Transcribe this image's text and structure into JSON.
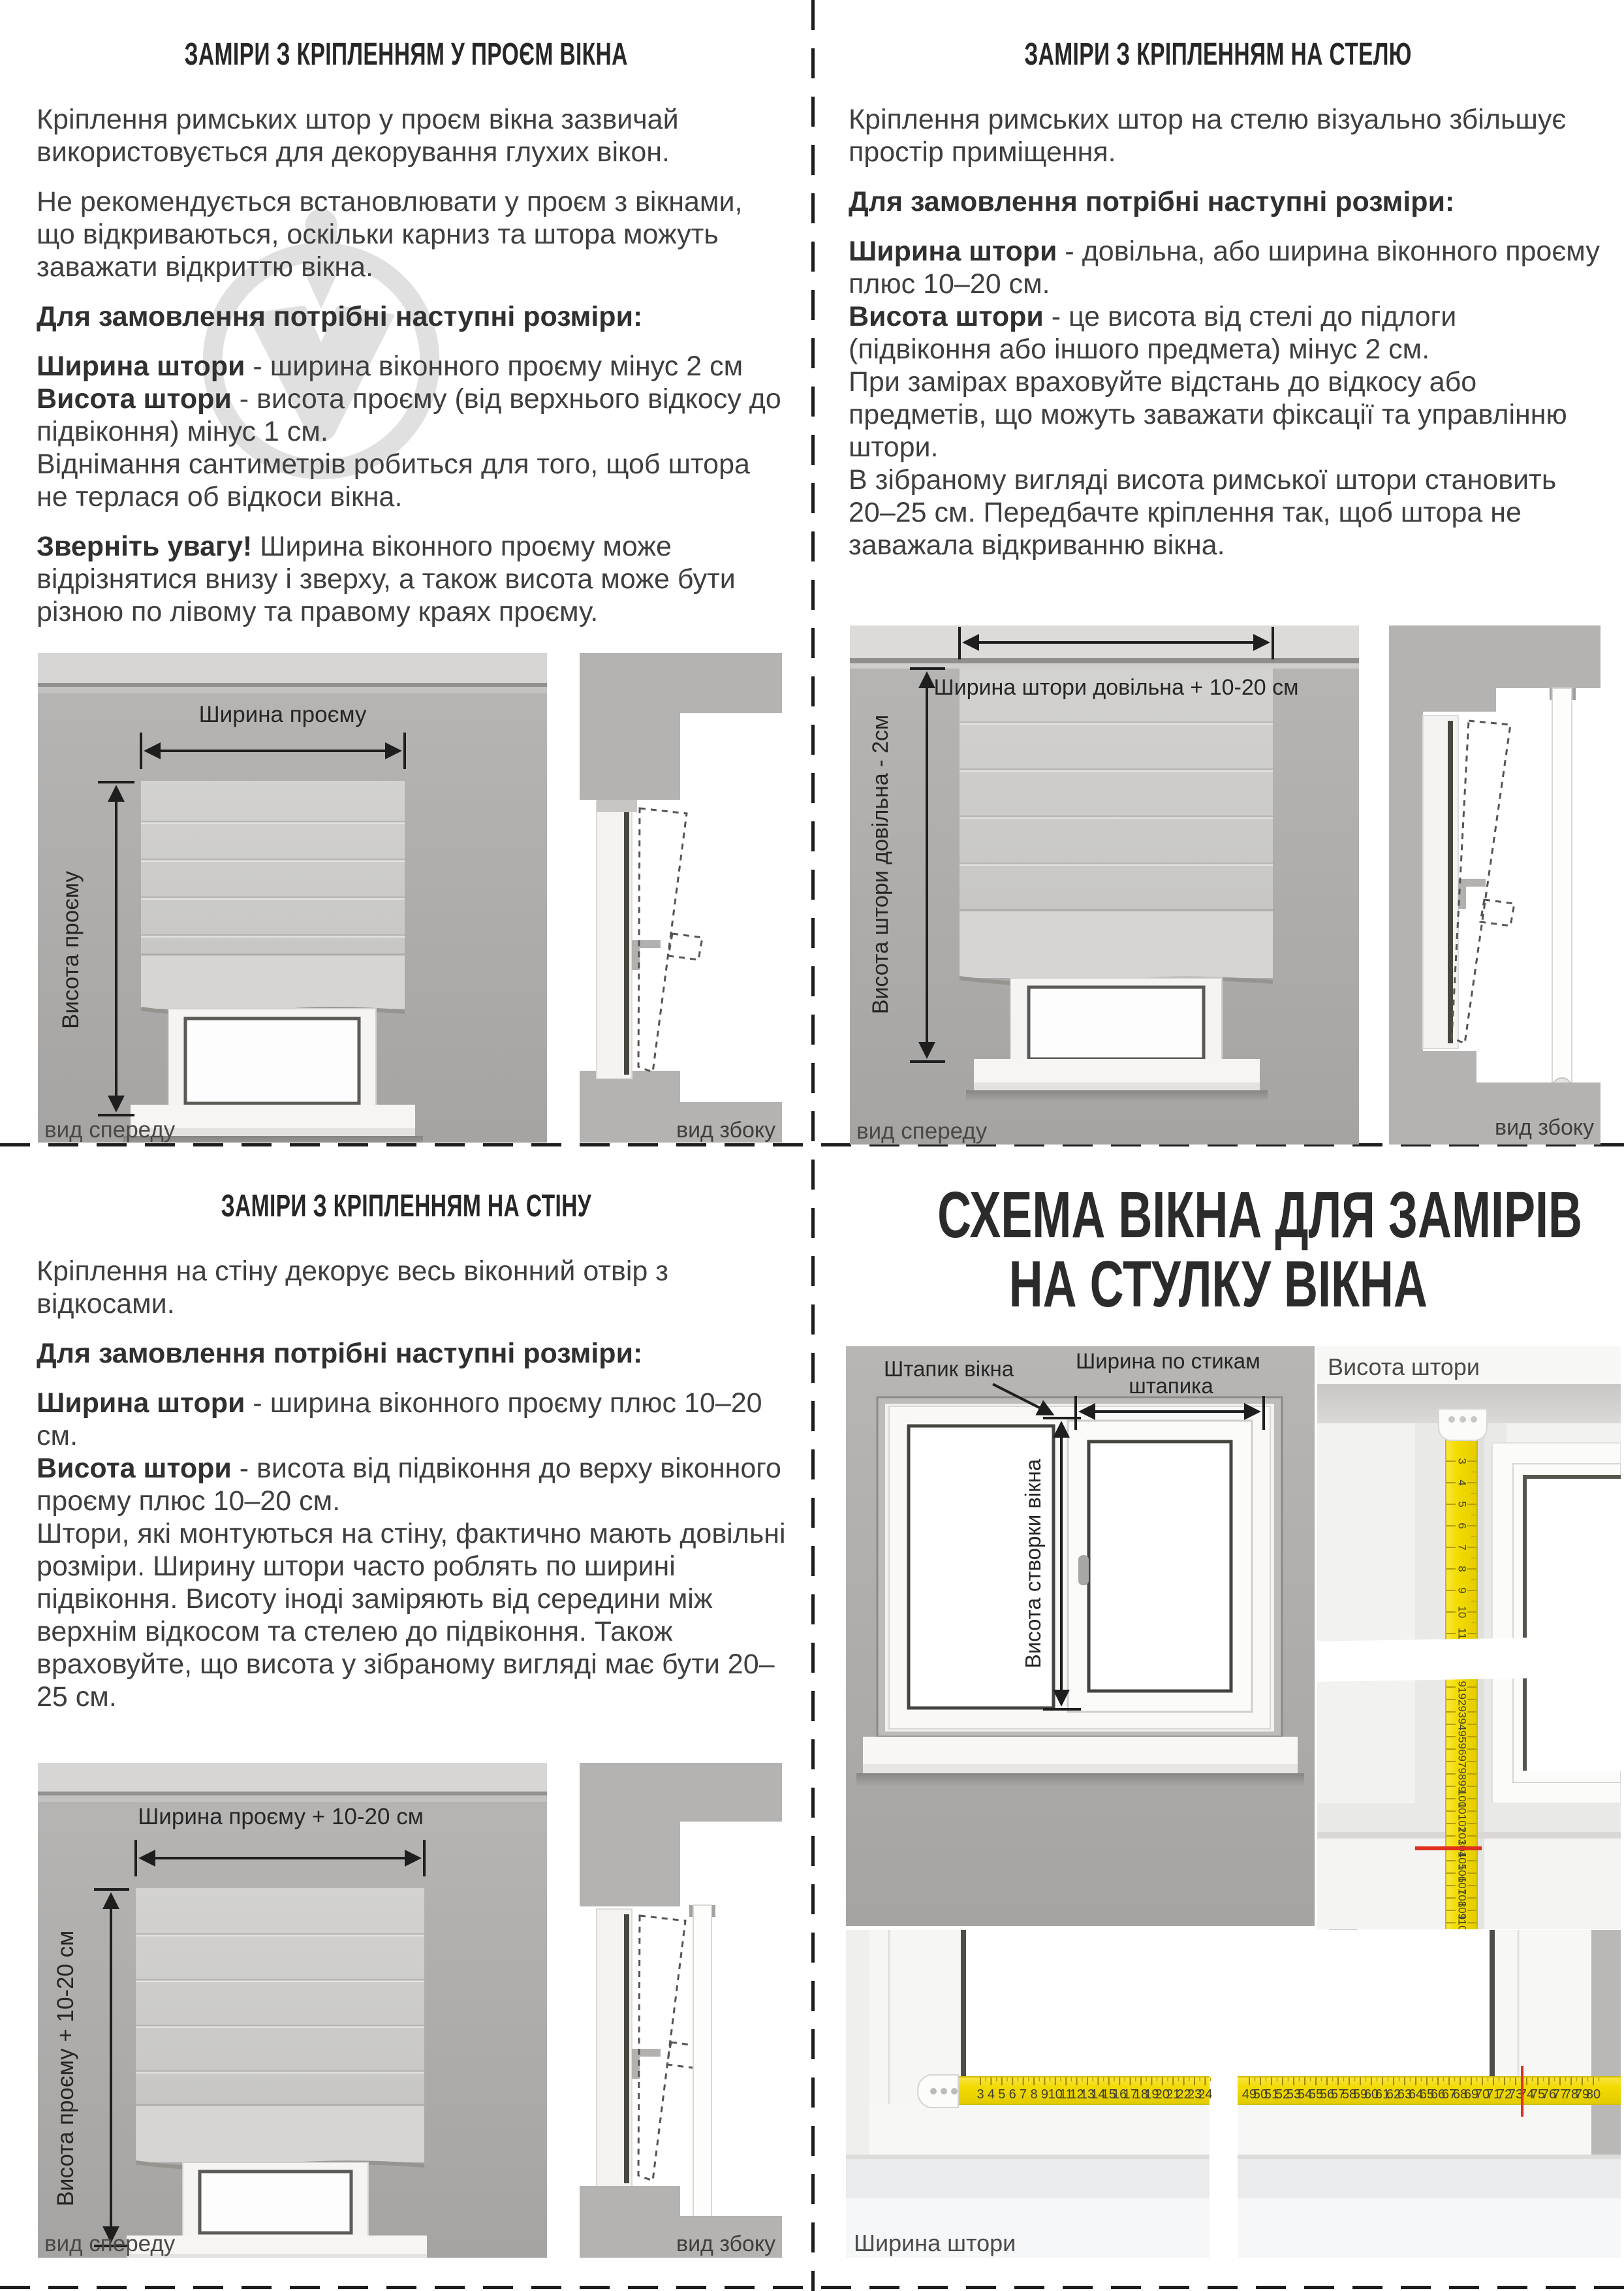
{
  "quad_opening": {
    "title": "ЗАМІРИ З КРІПЛЕННЯМ У ПРОЄМ ВІКНА",
    "p1": "Кріплення римських штор у проєм вікна зазвичай використовується для декорування глухих вікон.",
    "p2": "Не рекомендується встановлювати у проєм з вікнами, що відкриваються, оскільки карниз та штора можуть заважати відкриттю вікна.",
    "order_heading": "Для замовлення потрібні наступні розміри:",
    "width_term": "Ширина штори",
    "width_desc": " - ширина віконного проєму мінус 2 см",
    "height_term": "Висота штори",
    "height_desc": " - висота проєму (від верхнього відкосу до підвіконня) мінус 1 см.",
    "note": "Віднімання сантиметрів робиться для того, щоб штора не терлася об відкоси вікна.",
    "attention_lead": "Зверніть увагу!",
    "attention_rest": " Ширина віконного проєму може відрізнятися внизу і зверху, а також висота може бути різною по лівому та правому краях проєму.",
    "dim_width": "Ширина проєму",
    "dim_height": "Висота проєму",
    "front_caption": "вид спереду",
    "side_caption": "вид збоку"
  },
  "quad_ceiling": {
    "title": "ЗАМІРИ З КРІПЛЕННЯМ НА СТЕЛЮ",
    "p1": "Кріплення римських штор на стелю візуально збільшує простір приміщення.",
    "order_heading": "Для замовлення потрібні наступні розміри:",
    "width_term": "Ширина штори",
    "width_desc": " - довільна, або ширина віконного проєму плюс 10–20 см.",
    "height_term": "Висота штори",
    "height_desc": " - це висота від стелі до підлоги (підвіконня або іншого предмета) мінус 2 см.",
    "note1": "При замірах враховуйте відстань до відкосу або предметів, що можуть заважати фіксації та управлінню штори.",
    "note2": "В зібраному вигляді висота римської штори становить 20–25 см. Передбачте кріплення так, щоб штора не заважала відкриванню вікна.",
    "dim_width": "Ширина штори довільна + 10-20 см",
    "dim_height": "Висота штори довільна - 2см",
    "front_caption": "вид спереду",
    "side_caption": "вид збоку"
  },
  "quad_wall": {
    "title": "ЗАМІРИ З КРІПЛЕННЯМ НА СТІНУ",
    "p1": "Кріплення на стіну декорує весь віконний отвір з відкосами.",
    "order_heading": "Для замовлення потрібні наступні розміри:",
    "width_term": "Ширина штори",
    "width_desc": " - ширина віконного проєму плюс 10–20 см.",
    "height_term": "Висота штори",
    "height_desc": " - висота від підвіконня до верху віконного проєму плюс 10–20 см.",
    "body": "Штори, які монтуються на стіну, фактично мають довільні розміри. Ширину штори часто роблять по ширині підвіконня. Висоту іноді заміряють від середини між верхнім відкосом та стелею до підвіконня. Також враховуйте, що висота у зібраному вигляді має бути 20–25 см.",
    "dim_width": "Ширина проєму + 10-20 см",
    "dim_height": "Висота проєму + 10-20 см",
    "front_caption": "вид спереду",
    "side_caption": "вид збоку"
  },
  "quad_sash": {
    "title_line1": "СХЕМА ВІКНА ДЛЯ ЗАМІРІВ",
    "title_line2": "НА СТУЛКУ ВІКНА",
    "bead_label": "Штапик вікна",
    "stick_width_line1": "Ширина по стикам",
    "stick_width_line2": "штапика",
    "sash_height_label": "Висота створки вікна",
    "height_photo_label": "Висота штори",
    "width_photo_label": "Ширина штори",
    "colors": {
      "tape": "#f2dc00",
      "red_mark": "#e0301e"
    },
    "tapes": {
      "vertical": {
        "top_numbers": [
          3,
          4,
          5,
          6,
          7,
          8,
          9,
          10,
          11
        ],
        "bottom_numbers": [
          91,
          92,
          93,
          94,
          95,
          96,
          97,
          98,
          99,
          100,
          101,
          102,
          103,
          104,
          105,
          106,
          107,
          108,
          109,
          110
        ],
        "red_mark": 104
      },
      "horizontal": {
        "left_numbers": [
          3,
          4,
          5,
          6,
          7,
          8,
          9,
          10,
          11,
          12,
          13,
          14,
          15,
          16,
          17,
          18,
          19,
          20,
          21,
          22,
          23,
          24
        ],
        "right_numbers": [
          49,
          50,
          51,
          52,
          53,
          54,
          55,
          56,
          57,
          58,
          59,
          60,
          61,
          62,
          63,
          64,
          65,
          66,
          67,
          68,
          69,
          70,
          71,
          72,
          73,
          74,
          75,
          76,
          77,
          78,
          79,
          80
        ],
        "red_mark": 73
      }
    }
  }
}
